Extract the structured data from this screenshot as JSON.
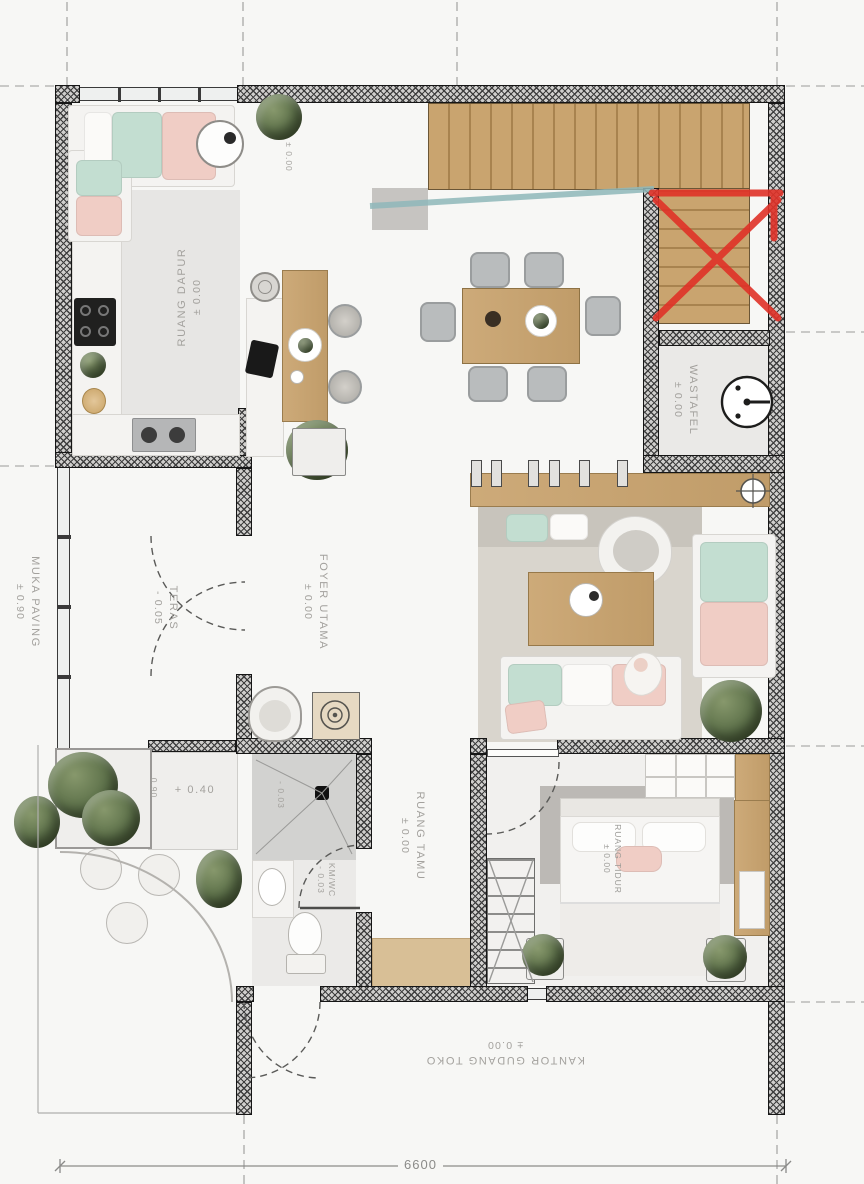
{
  "plan": {
    "title": "house-floor-plan",
    "labels": {
      "kitchen": {
        "name": "RUANG DAPUR",
        "level": "± 0.00"
      },
      "stairs": {
        "level": "± 0.00"
      },
      "teras": {
        "name": "TERAS",
        "level": "- 0.05"
      },
      "foyer": {
        "name": "FOYER UTAMA",
        "level": "± 0.00"
      },
      "hall": {
        "name": "RUANG TAMU",
        "level": "± 0.00"
      },
      "wastafel": {
        "name": "WASTAFEL",
        "level": "± 0.00"
      },
      "bedroom": {
        "name": "RUANG TIDUR",
        "level": "± 0.00"
      },
      "bathroom": {
        "name": "KM/WC",
        "level": "- 0.03"
      },
      "shower": {
        "level": "- 0.03"
      },
      "kantor": {
        "name": "KANTOR GUDANG TOKO",
        "level": "± 0.00"
      },
      "muka_paving": {
        "name": "MUKA PAVING",
        "level": "± 0.90"
      },
      "step": {
        "level": "+ 0.40"
      },
      "planter": {
        "level": "0.90"
      }
    },
    "dimension": {
      "width": "6600"
    },
    "colors": {
      "wall_hatch": "#3e3e3e",
      "wood": "#c9a46f",
      "mint": "#c3ded1",
      "pink": "#f0cdc5",
      "red_mark": "#e03228",
      "glass_rail": "#8fb8ba",
      "label_gray": "#a3a19d",
      "rug": "#d9d5cd"
    }
  }
}
